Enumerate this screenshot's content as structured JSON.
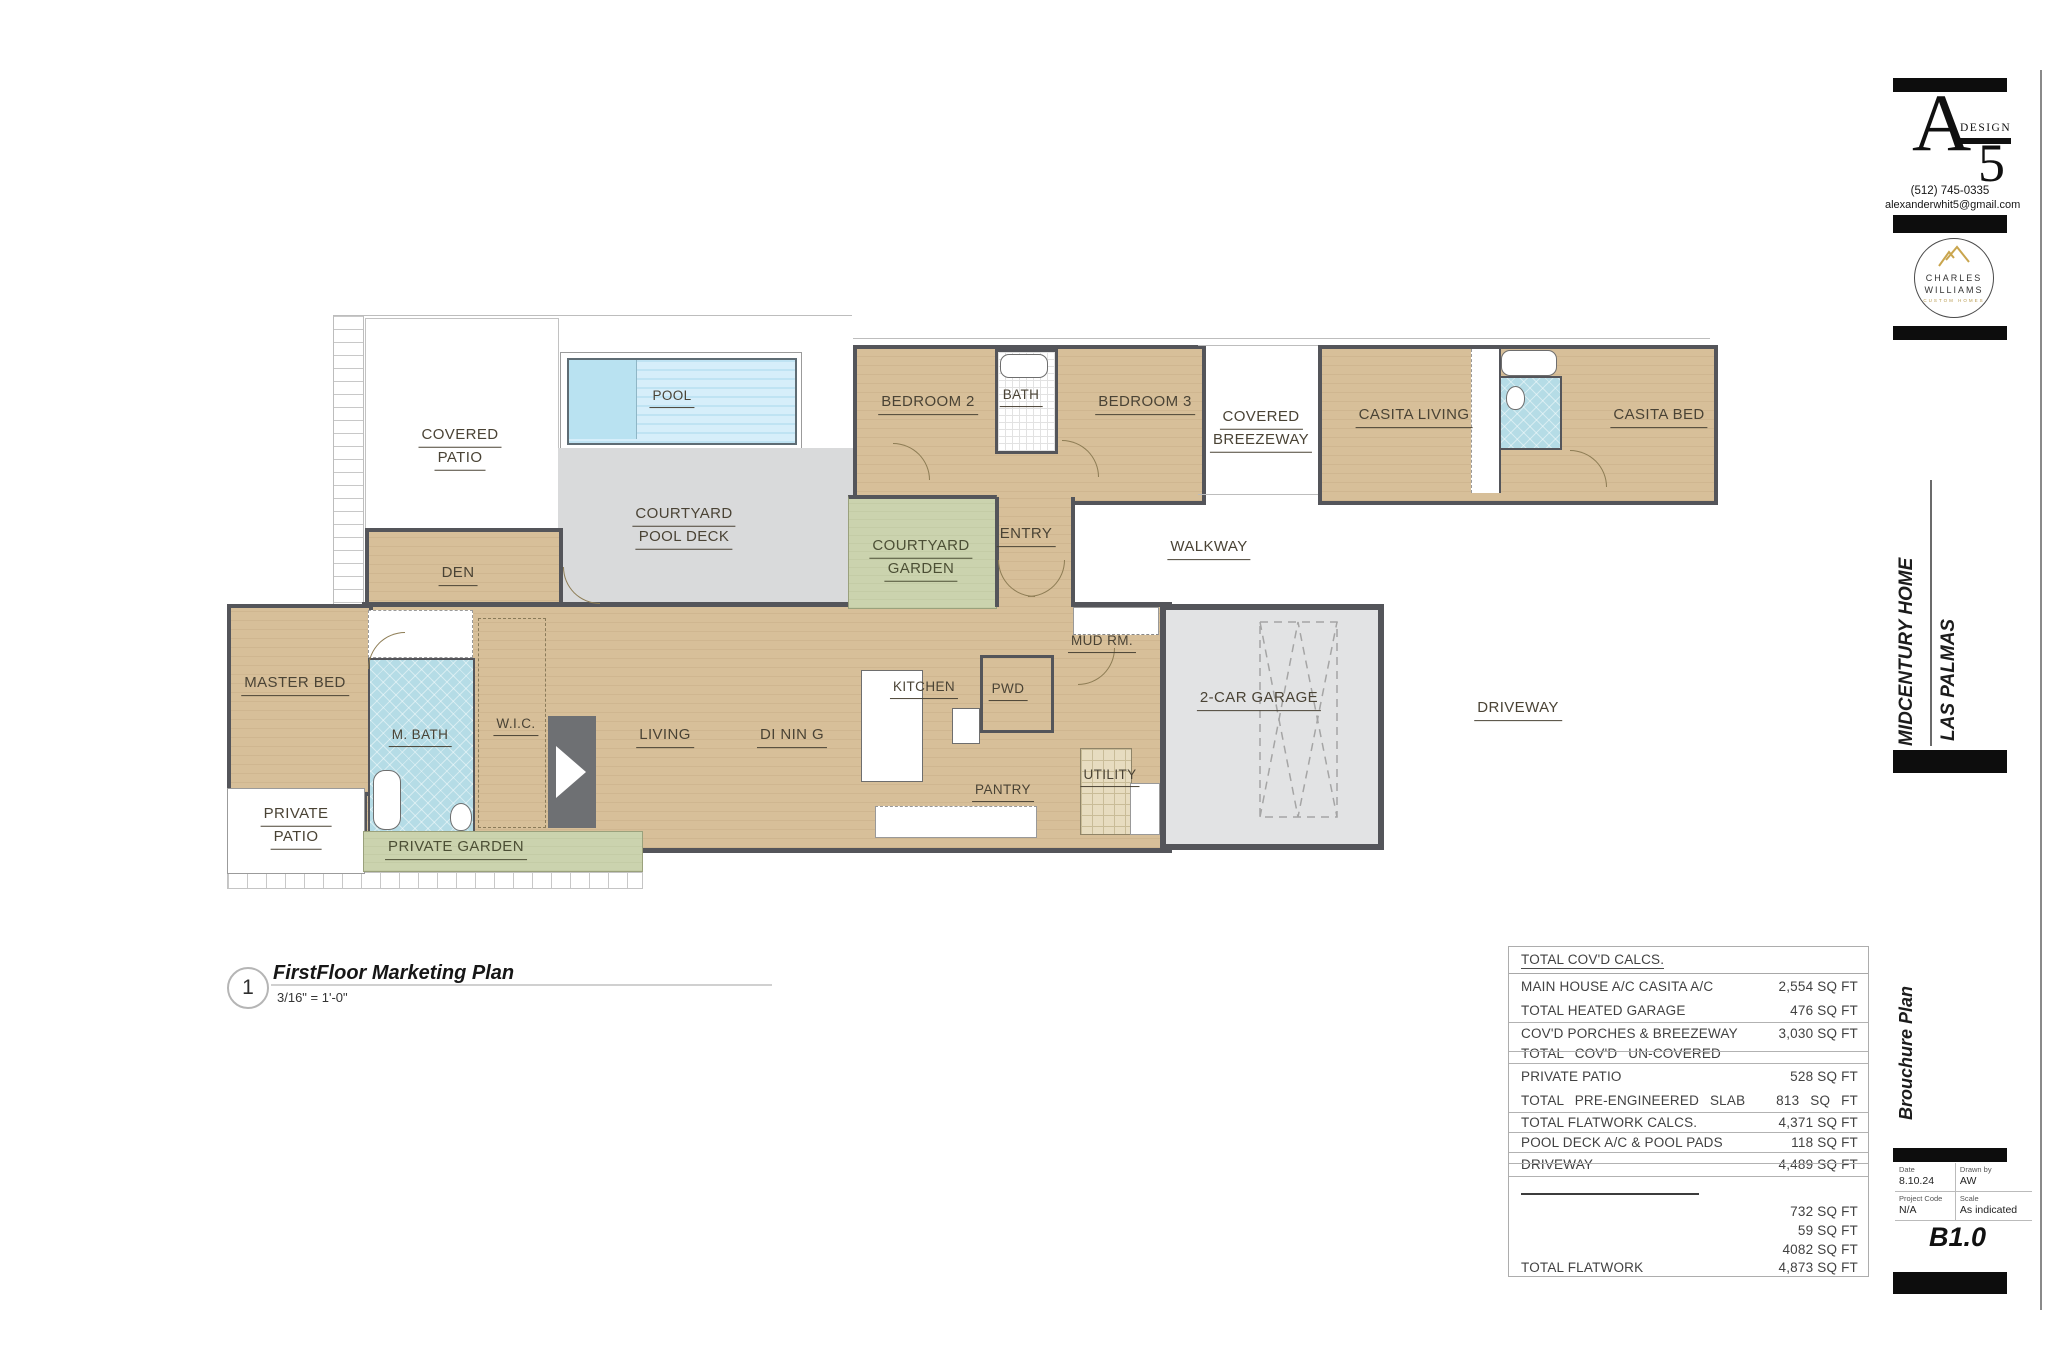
{
  "plan_callout": {
    "number": "1",
    "title": "FirstFloor Marketing Plan",
    "scale": "3/16\" = 1'-0\""
  },
  "rooms": {
    "covered_patio": [
      "COVERED",
      "PATIO"
    ],
    "pool": "POOL",
    "courtyard_pool_deck": [
      "COURTYARD",
      "POOL DECK"
    ],
    "den": "DEN",
    "master_bed": "MASTER BED",
    "m_bath": "M. BATH",
    "wic": "W.I.C.",
    "private_patio": [
      "PRIVATE",
      "PATIO"
    ],
    "private_garden": "PRIVATE GARDEN",
    "living": "LIVING",
    "dining": "DI NIN G",
    "kitchen": "KITCHEN",
    "pwd": "PWD",
    "pantry": "PANTRY",
    "utility": "UTILITY",
    "mud_rm": "MUD RM.",
    "garage": "2-CAR GARAGE",
    "driveway": "DRIVEWAY",
    "entry": "ENTRY",
    "walkway": "WALKWAY",
    "courtyard_garden": [
      "COURTYARD",
      "GARDEN"
    ],
    "bedroom2": "BEDROOM 2",
    "bath": "BATH",
    "bedroom3": "BEDROOM 3",
    "covered_breezeway": [
      "COVERED",
      "BREEZEWAY"
    ],
    "casita_living": "CASITA LIVING",
    "casita_bed": "CASITA BED"
  },
  "calc_table": {
    "header": "TOTAL COV'D CALCS.",
    "rows": [
      {
        "label": "MAIN HOUSE A/C CASITA A/C",
        "value": "2,554 SQ FT"
      },
      {
        "label": "TOTAL HEATED GARAGE",
        "value": "476 SQ FT"
      },
      {
        "label": "COV'D PORCHES & BREEZEWAY",
        "value": "3,030 SQ FT"
      },
      {
        "label": "TOTAL COV'D UN-COVERED",
        "value": ""
      },
      {
        "label": "PRIVATE PATIO",
        "value": "528 SQ FT"
      },
      {
        "label": "TOTAL PRE-ENGINEERED SLAB",
        "value": "813 SQ FT"
      },
      {
        "label": "TOTAL FLATWORK CALCS.",
        "value": "4,371 SQ FT"
      },
      {
        "label": "POOL DECK A/C & POOL PADS",
        "value": "118 SQ FT"
      },
      {
        "label": "DRIVEWAY",
        "value": "4,489 SQ FT"
      },
      {
        "label": "",
        "value": "732 SQ FT"
      },
      {
        "label": "",
        "value": "59 SQ FT"
      },
      {
        "label": "",
        "value": "4082 SQ FT"
      },
      {
        "label": "TOTAL FLATWORK",
        "value": "4,873 SQ FT"
      }
    ]
  },
  "titleblock": {
    "a5": {
      "letter": "A",
      "word": "DESIGN",
      "number": "5"
    },
    "phone": "(512) 745-0335",
    "email": "alexanderwhit5@gmail.com",
    "builder": {
      "line1": "CHARLES",
      "line2": "WILLIAMS",
      "line3": "CUSTOM HOMES"
    },
    "project_name": "MIDCENTURY HOME",
    "project_location": "LAS PALMAS",
    "sheet_name": "Brouchure Plan",
    "date_label": "Date",
    "date": "8.10.24",
    "drawn_by_label": "Drawn by",
    "drawn_by": "AW",
    "project_code_label": "Project Code",
    "project_code": "N/A",
    "scale_label": "Scale",
    "scale": "As indicated",
    "sheet_number": "B1.0"
  },
  "colors": {
    "room_tan": "#d7bf99",
    "garden_green": "#cbd3ae",
    "bath_blue": "#b5dce6",
    "pool_blue": "#d6eefa",
    "deck_gray": "#d9dadb",
    "garage_gray": "#e2e3e4",
    "wall_gray": "#54555a",
    "label_brown": "#4a4335",
    "logo_gold": "#b89a4f"
  }
}
